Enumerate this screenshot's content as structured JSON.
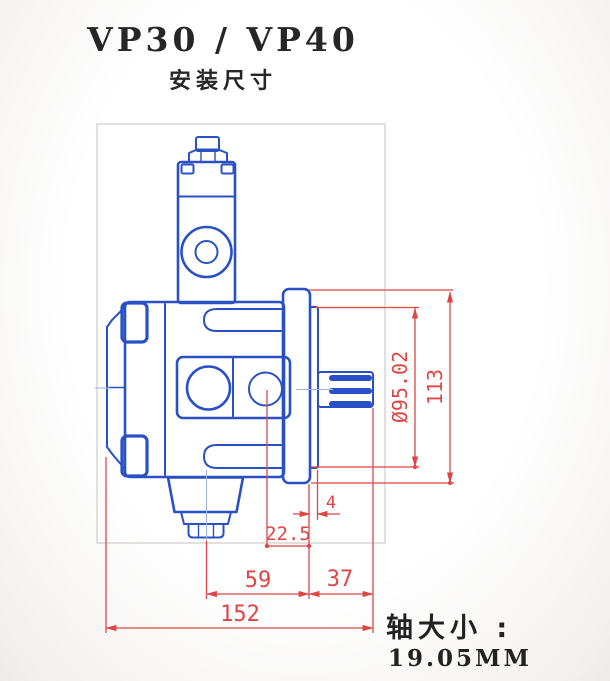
{
  "header": {
    "title": "VP30 / VP40",
    "subtitle": "安装尺寸"
  },
  "drawing": {
    "part_line_color": "#2a50c5",
    "dimension_color": "#e04545",
    "frame_color": "#d6d3d1",
    "dimensions": {
      "pilot_diameter": "Ø95.02",
      "flange_height": "113",
      "pilot_step": "4",
      "port_center_to_flange_face": "22.5",
      "center_to_flange_face": "59",
      "flange_face_to_shaft_end": "37",
      "overall_width": "152"
    }
  },
  "footer": {
    "shaft_size_label": "轴大小 :",
    "shaft_size_value": "19.05MM"
  }
}
